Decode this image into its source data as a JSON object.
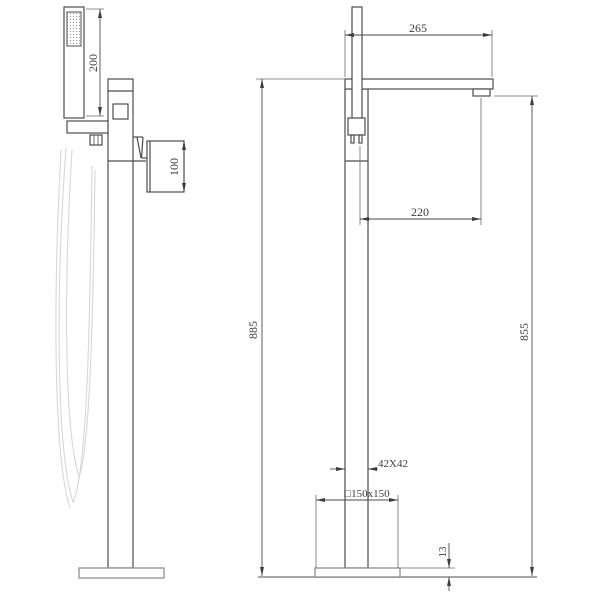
{
  "drawing": {
    "type": "technical-dimension-drawing",
    "subject": "freestanding-bathtub-faucet-two-views",
    "colors": {
      "background": "#ffffff",
      "line": "#4c4c4c",
      "dimension_line": "#4a4a4a",
      "ground_line": "#a8a8a8",
      "hose_line": "#d7d7d7",
      "text": "#3d3d3d"
    },
    "dims": {
      "shower_length": "200",
      "handle_height": "100",
      "spout_reach": "265",
      "outlet_offset": "220",
      "overall_height": "885",
      "outlet_height": "855",
      "post_section": "42X42",
      "base_plate": "□150x150",
      "base_thickness": "13"
    }
  }
}
